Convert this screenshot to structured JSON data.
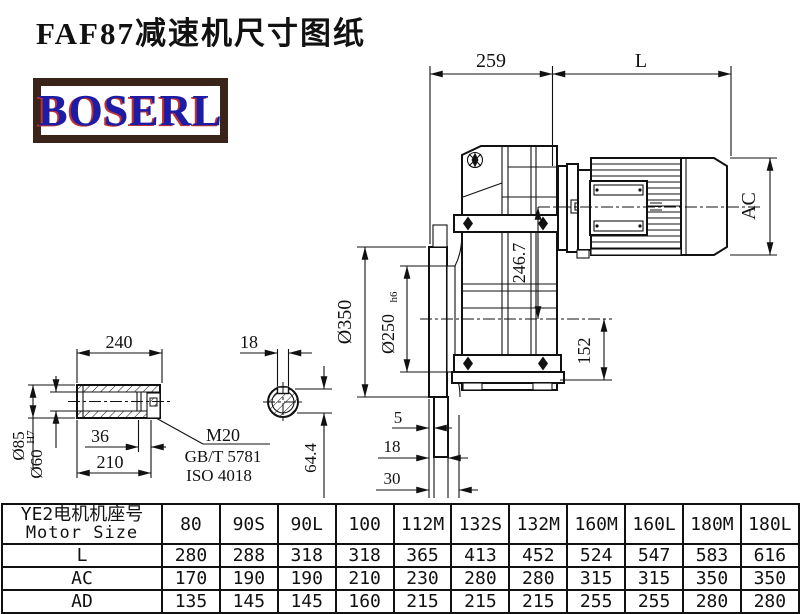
{
  "header": {
    "title": "FAF87减速机尺寸图纸",
    "logo_text": "BOSERL",
    "logo_text_color": "#1c1ca6",
    "logo_border_color": "#3a241a",
    "logo_shadow_color": "#c03030"
  },
  "drawing": {
    "dims": {
      "shaft_length": "240",
      "shaft_od": "Ø85",
      "bore": "Ø60",
      "bore_tol": "H7",
      "thread_depth": "36",
      "hub_length": "210",
      "thread": "M20",
      "std_gb": "GB/T 5781",
      "std_iso": "ISO 4018",
      "keyway_width": "18",
      "keyway_depth": "64.4",
      "housing_length": "259",
      "motor_length": "L",
      "motor_od": "AC",
      "center_height": "246.7",
      "flange_od": "Ø350",
      "flange_spigot": "Ø250",
      "flange_spigot_tol": "h6",
      "base_height": "152",
      "flange_step1": "5",
      "flange_step2": "18",
      "flange_step3": "30"
    }
  },
  "table": {
    "header": {
      "line1": "YE2电机机座号",
      "line2": "Motor Size"
    },
    "columns": [
      "80",
      "90S",
      "90L",
      "100",
      "112M",
      "132S",
      "132M",
      "160M",
      "160L",
      "180M",
      "180L"
    ],
    "rows": [
      {
        "label": "L",
        "values": [
          "280",
          "288",
          "318",
          "318",
          "365",
          "413",
          "452",
          "524",
          "547",
          "583",
          "616"
        ]
      },
      {
        "label": "AC",
        "values": [
          "170",
          "190",
          "190",
          "210",
          "230",
          "280",
          "280",
          "315",
          "315",
          "350",
          "350"
        ]
      },
      {
        "label": "AD",
        "values": [
          "135",
          "145",
          "145",
          "160",
          "215",
          "215",
          "215",
          "255",
          "255",
          "280",
          "280"
        ]
      }
    ]
  }
}
